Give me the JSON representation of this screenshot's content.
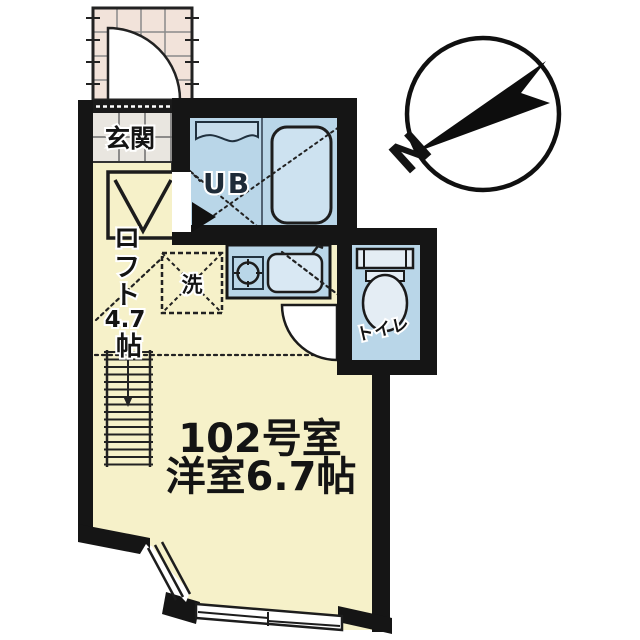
{
  "labels": {
    "entrance": "玄関",
    "unit_bath": "UB",
    "washer": "洗",
    "toilet": "トイレ",
    "loft_chars": [
      "ロ",
      "フ",
      "ト",
      "4.7",
      "帖"
    ],
    "room_line1": "102号室",
    "room_line2": "洋室6.7帖",
    "compass_north": "N"
  },
  "colors": {
    "wall": "#151515",
    "floor_yellow": "#f6f1c9",
    "fixture_blue": "#b9d6e8",
    "fixture_blue_light": "#d9e8f3",
    "porch_tile": "#f2e3da",
    "entry_tile": "#e9e6e0",
    "line_dark": "#1d1d1d"
  }
}
